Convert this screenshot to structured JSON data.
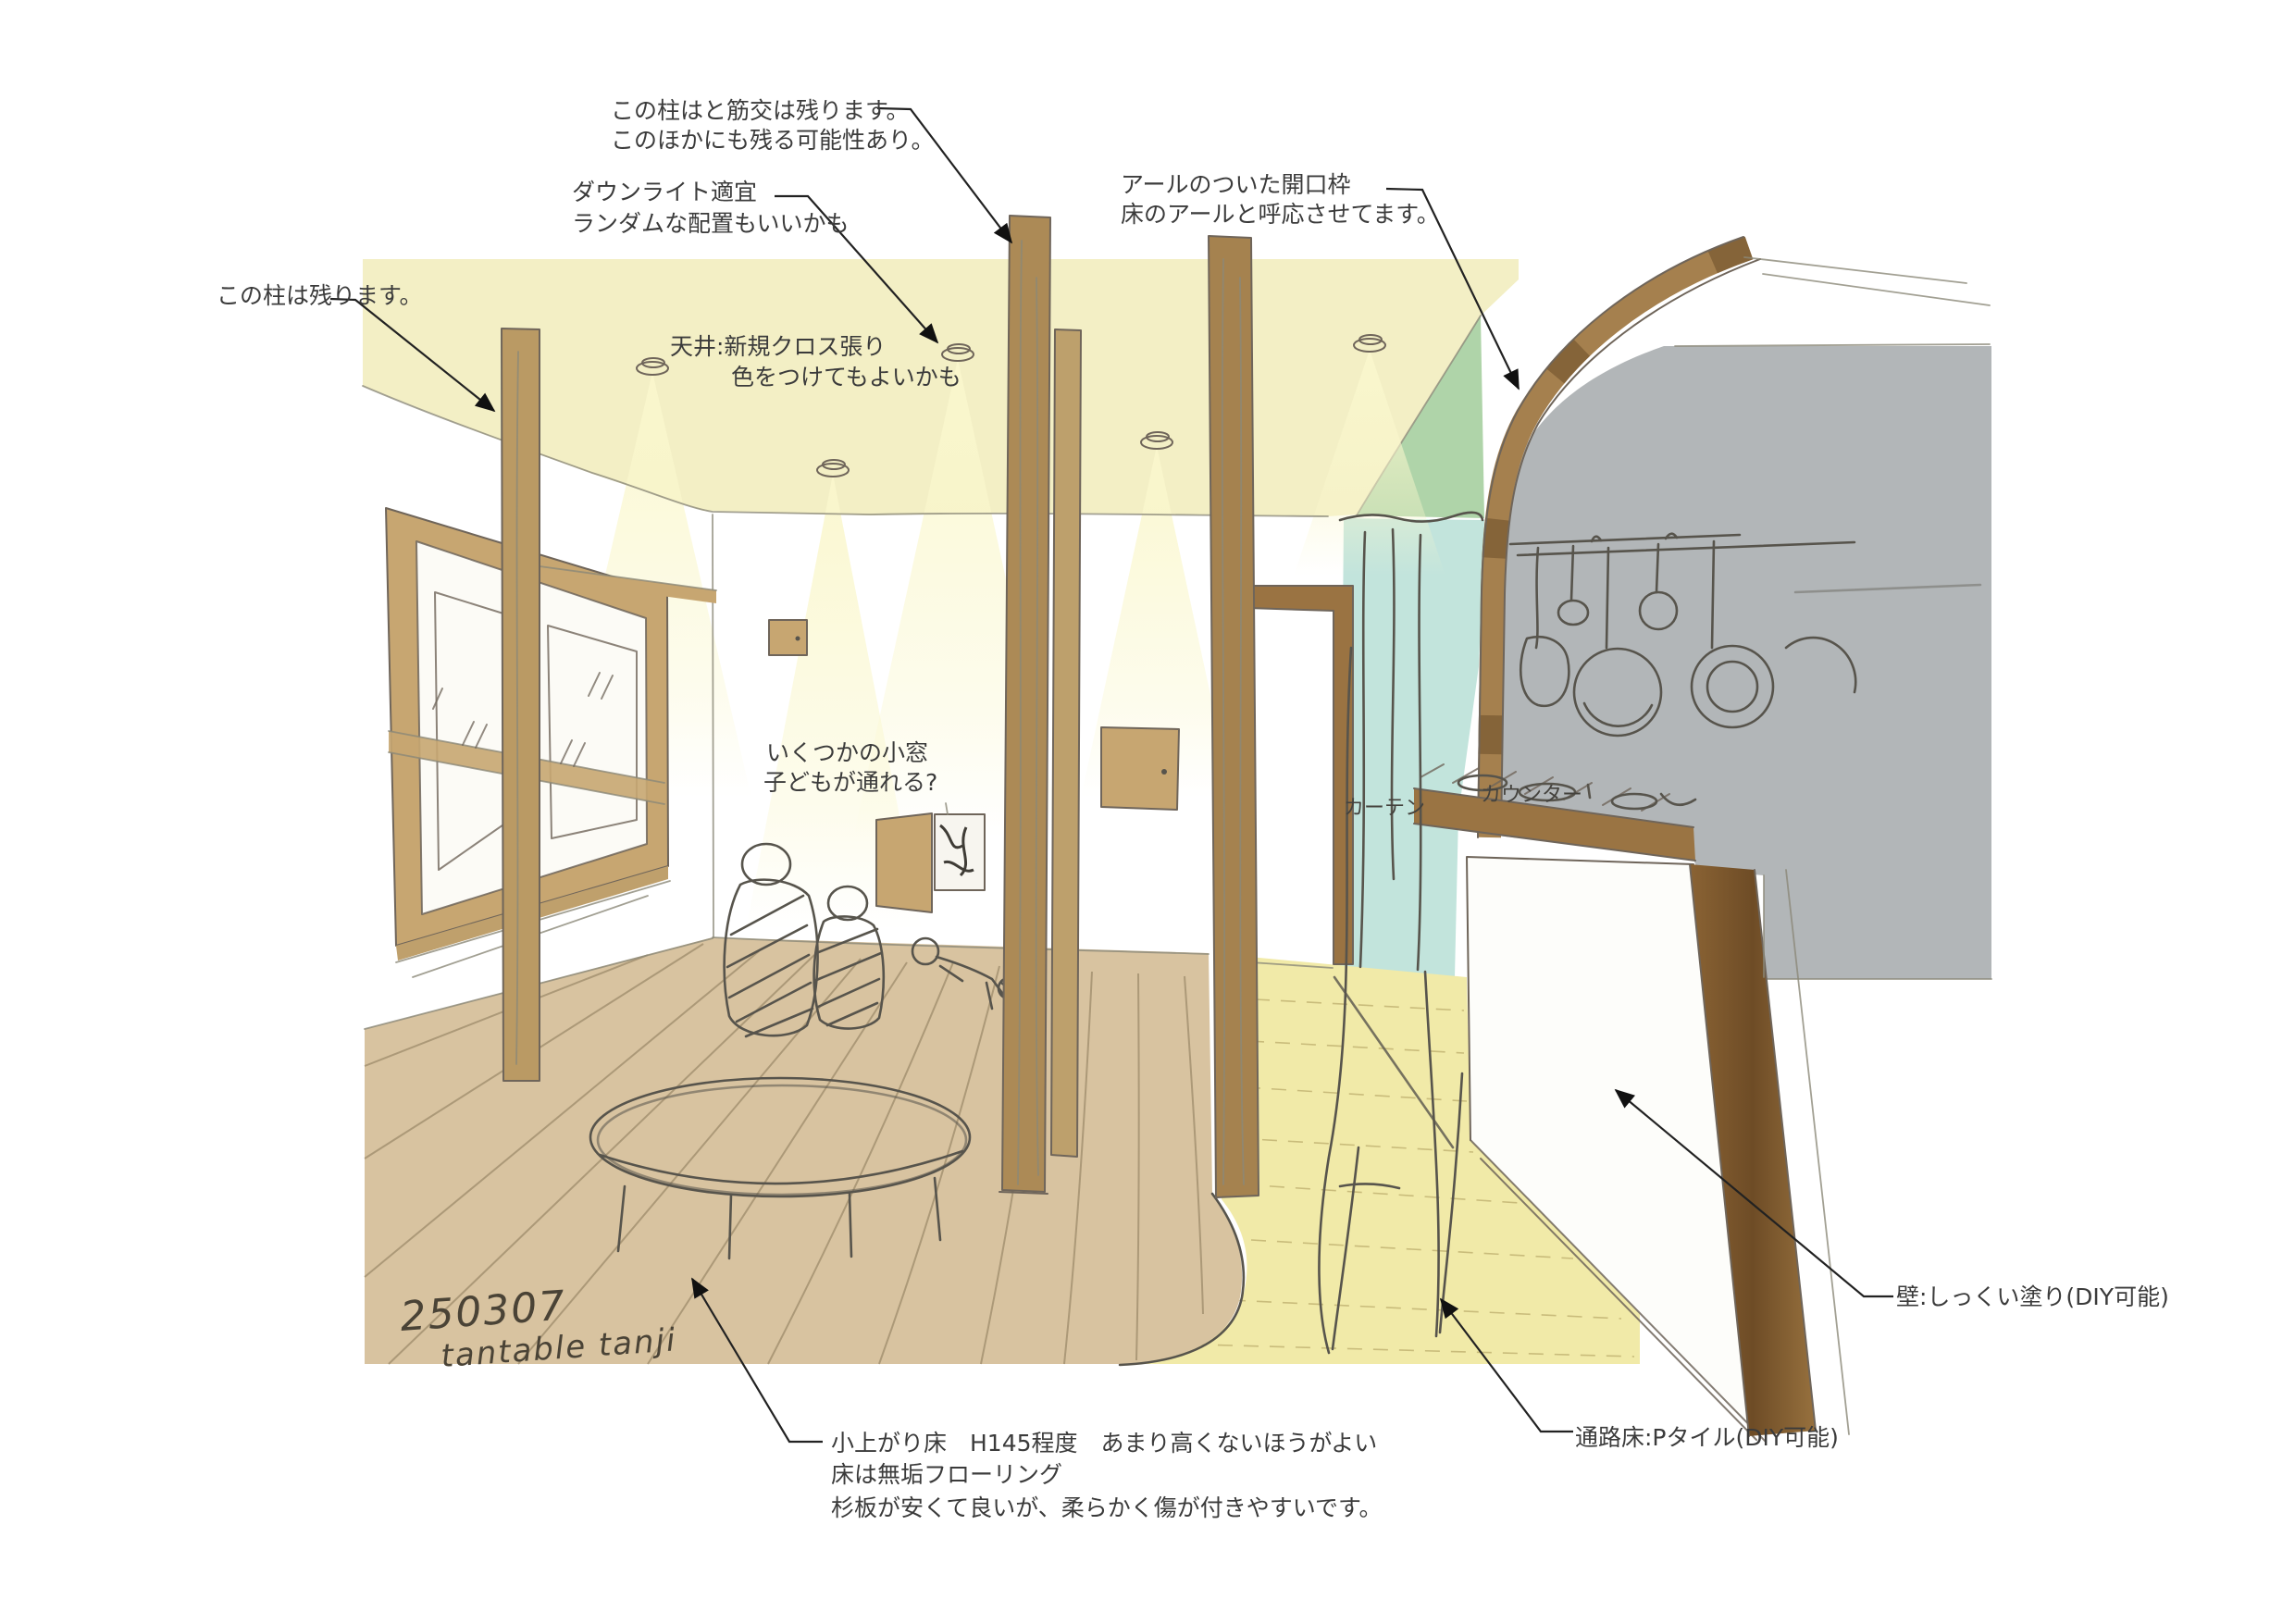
{
  "document": {
    "type": "hand-drawn interior perspective sketch (renovation plan)",
    "date_code": "250307",
    "author_note": "tantable tanji"
  },
  "annotations": {
    "pillar_brace": {
      "line1": "この柱はと筋交は残ります。",
      "line2": "このほかにも残る可能性あり。"
    },
    "downlight": {
      "line1": "ダウンライト適宜",
      "line2": "ランダムな配置もいいかも"
    },
    "arch_opening": {
      "line1": "アールのついた開口枠",
      "line2": "床のアールと呼応させてます。"
    },
    "pillar_keep": {
      "line1": "この柱は残ります。"
    },
    "ceiling": {
      "line1": "天井:新規クロス張り",
      "line2": "色をつけてもよいかも"
    },
    "small_windows": {
      "line1": "いくつかの小窓",
      "line2": "子どもが通れる?"
    },
    "curtain": {
      "label": "カーテン"
    },
    "counter": {
      "label": "カウンター"
    },
    "wall": {
      "label": "壁:しっくい塗り(DIY可能)"
    },
    "passage_floor": {
      "label": "通路床:Pタイル(DIY可能)"
    },
    "raised_floor": {
      "line1": "小上がり床　H145程度　あまり高くないほうがよい",
      "line2": "床は無垢フローリング",
      "line3": "杉板が安くて良いが、柔らかく傷が付きやすいです。"
    },
    "signature": {
      "line1": "250307",
      "line2": "tantable tanji"
    }
  },
  "colors": {
    "ceiling": "#f3efc5",
    "light_cone": "#faf7cd",
    "pillar_wood": "#ac8a56",
    "window_frame": "#c7a671",
    "raised_floor": "#d8c3a0",
    "passage_floor": "#f1eaa8",
    "curtain_teal": "#c2e4dc",
    "green_floor": "#b7dcb4",
    "green_wall": "#a6cfa0",
    "kitchen_gray": "#b2b6b8",
    "dark_wood": "#9a7342",
    "pencil": "#57544c",
    "annotation_text": "#3b3b3b"
  }
}
